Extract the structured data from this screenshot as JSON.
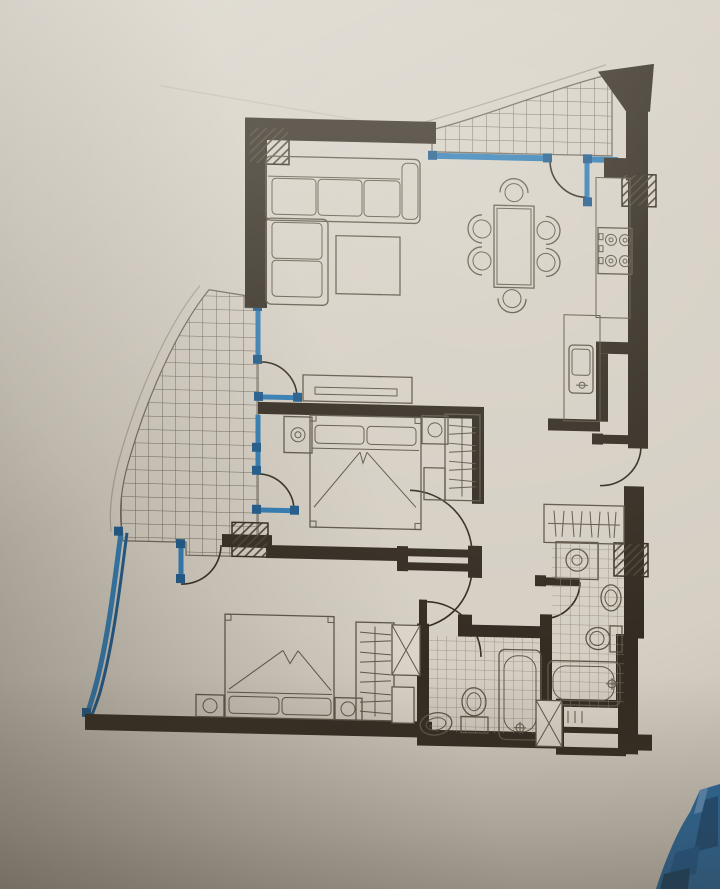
{
  "meta": {
    "description": "Photographed hand-drafted architectural floor plan of a two-bedroom apartment; no text labels are printed on the drawing",
    "visible_text": "none",
    "drawing_conventions": {
      "solid_black": "structural walls",
      "blue_lines": "glazed windows and balcony doors",
      "grid_hatch_areas": "tiled balconies and bathroom floors",
      "diagonal_hatch_squares": "columns",
      "x_marked_boxes": "service shafts"
    }
  },
  "colors": {
    "paper": "#d5cfc4",
    "ink": "#342c22",
    "furniture_line": "#5f5749",
    "grid_line": "#6e675c",
    "tile_line": "#8f8779",
    "glazing": "#2f7cb5",
    "glazing_dark": "#1d5a8c",
    "blue_object": "#2a6da5"
  },
  "rooms": [
    {
      "id": "living-room",
      "position": "top-left",
      "furniture": [
        "l-shaped-sofa",
        "coffee-table",
        "tv-cabinet"
      ]
    },
    {
      "id": "dining-area",
      "position": "top-center",
      "furniture": [
        "dining-table",
        "six-chairs"
      ]
    },
    {
      "id": "kitchen",
      "position": "top-right",
      "fixtures": [
        "four-burner-stove",
        "counter",
        "double-sink"
      ],
      "doors": [
        "door-to-corridor"
      ]
    },
    {
      "id": "balcony-top",
      "position": "top-right",
      "features": [
        "tiled-floor",
        "curved-parapet",
        "glazed-door"
      ]
    },
    {
      "id": "balcony-left",
      "position": "left",
      "features": [
        "tiled-floor",
        "curved-parapet",
        "glazed-doors"
      ]
    },
    {
      "id": "bedroom-1",
      "position": "center",
      "furniture": [
        "double-bed",
        "nightstand-left",
        "nightstand-right",
        "wardrobe-with-hangers"
      ],
      "windows": [
        "balcony-window",
        "balcony-door"
      ]
    },
    {
      "id": "bedroom-2",
      "position": "bottom-left",
      "furniture": [
        "double-bed",
        "nightstand-left",
        "nightstand-right",
        "wardrobe-with-hangers"
      ],
      "windows": [
        "curved-glazed-wall",
        "balcony-door"
      ]
    },
    {
      "id": "hallway",
      "position": "center",
      "doors": [
        "bedroom-1-door",
        "bedroom-2-door",
        "bathroom-1-door"
      ]
    },
    {
      "id": "bathroom-1",
      "position": "bottom-center",
      "fixtures": [
        "pedestal-basin",
        "toilet",
        "bathtub"
      ],
      "floor": "tiled"
    },
    {
      "id": "bathroom-2",
      "position": "bottom-right",
      "fixtures": [
        "washing-machine",
        "basin",
        "toilet",
        "bathtub"
      ],
      "floor": "tiled"
    },
    {
      "id": "entry-corridor",
      "position": "right",
      "features": [
        "hanger-closet"
      ]
    },
    {
      "id": "shafts",
      "items": [
        "x-shaft-left",
        "x-shaft-right",
        "riser-boxes",
        "hatched-column-top-left",
        "hatched-column-top-right",
        "hatched-column-mid-left",
        "hatched-column-bathroom-2"
      ]
    }
  ],
  "photo_artifacts": {
    "blue_object_bottom_right": "corner of a blue plastic object lying on the plan",
    "lighting": "warm paper with shadow falling toward bottom-left"
  }
}
